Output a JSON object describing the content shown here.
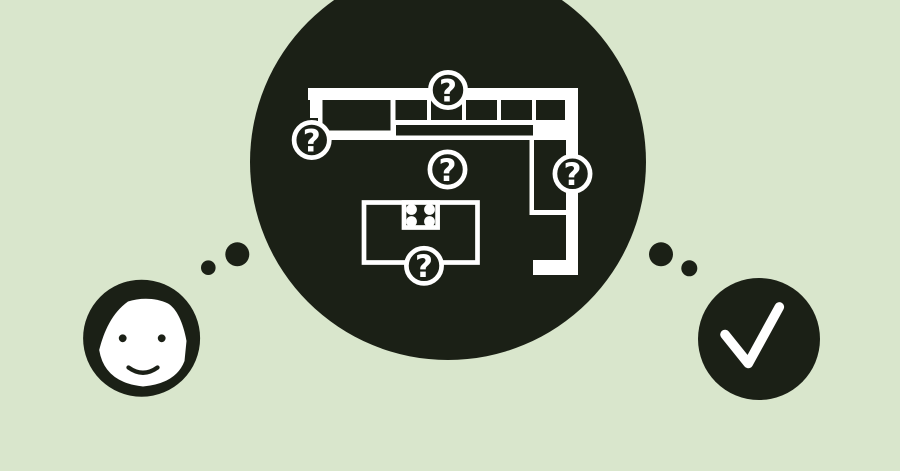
{
  "colors": {
    "background": "#d9e6cc",
    "ink": "#1b2016",
    "paper": "#ffffff"
  },
  "thought_bubble": {
    "question_badges": [
      {
        "label": "?"
      },
      {
        "label": "?"
      },
      {
        "label": "?"
      },
      {
        "label": "?"
      },
      {
        "label": "?"
      }
    ]
  }
}
